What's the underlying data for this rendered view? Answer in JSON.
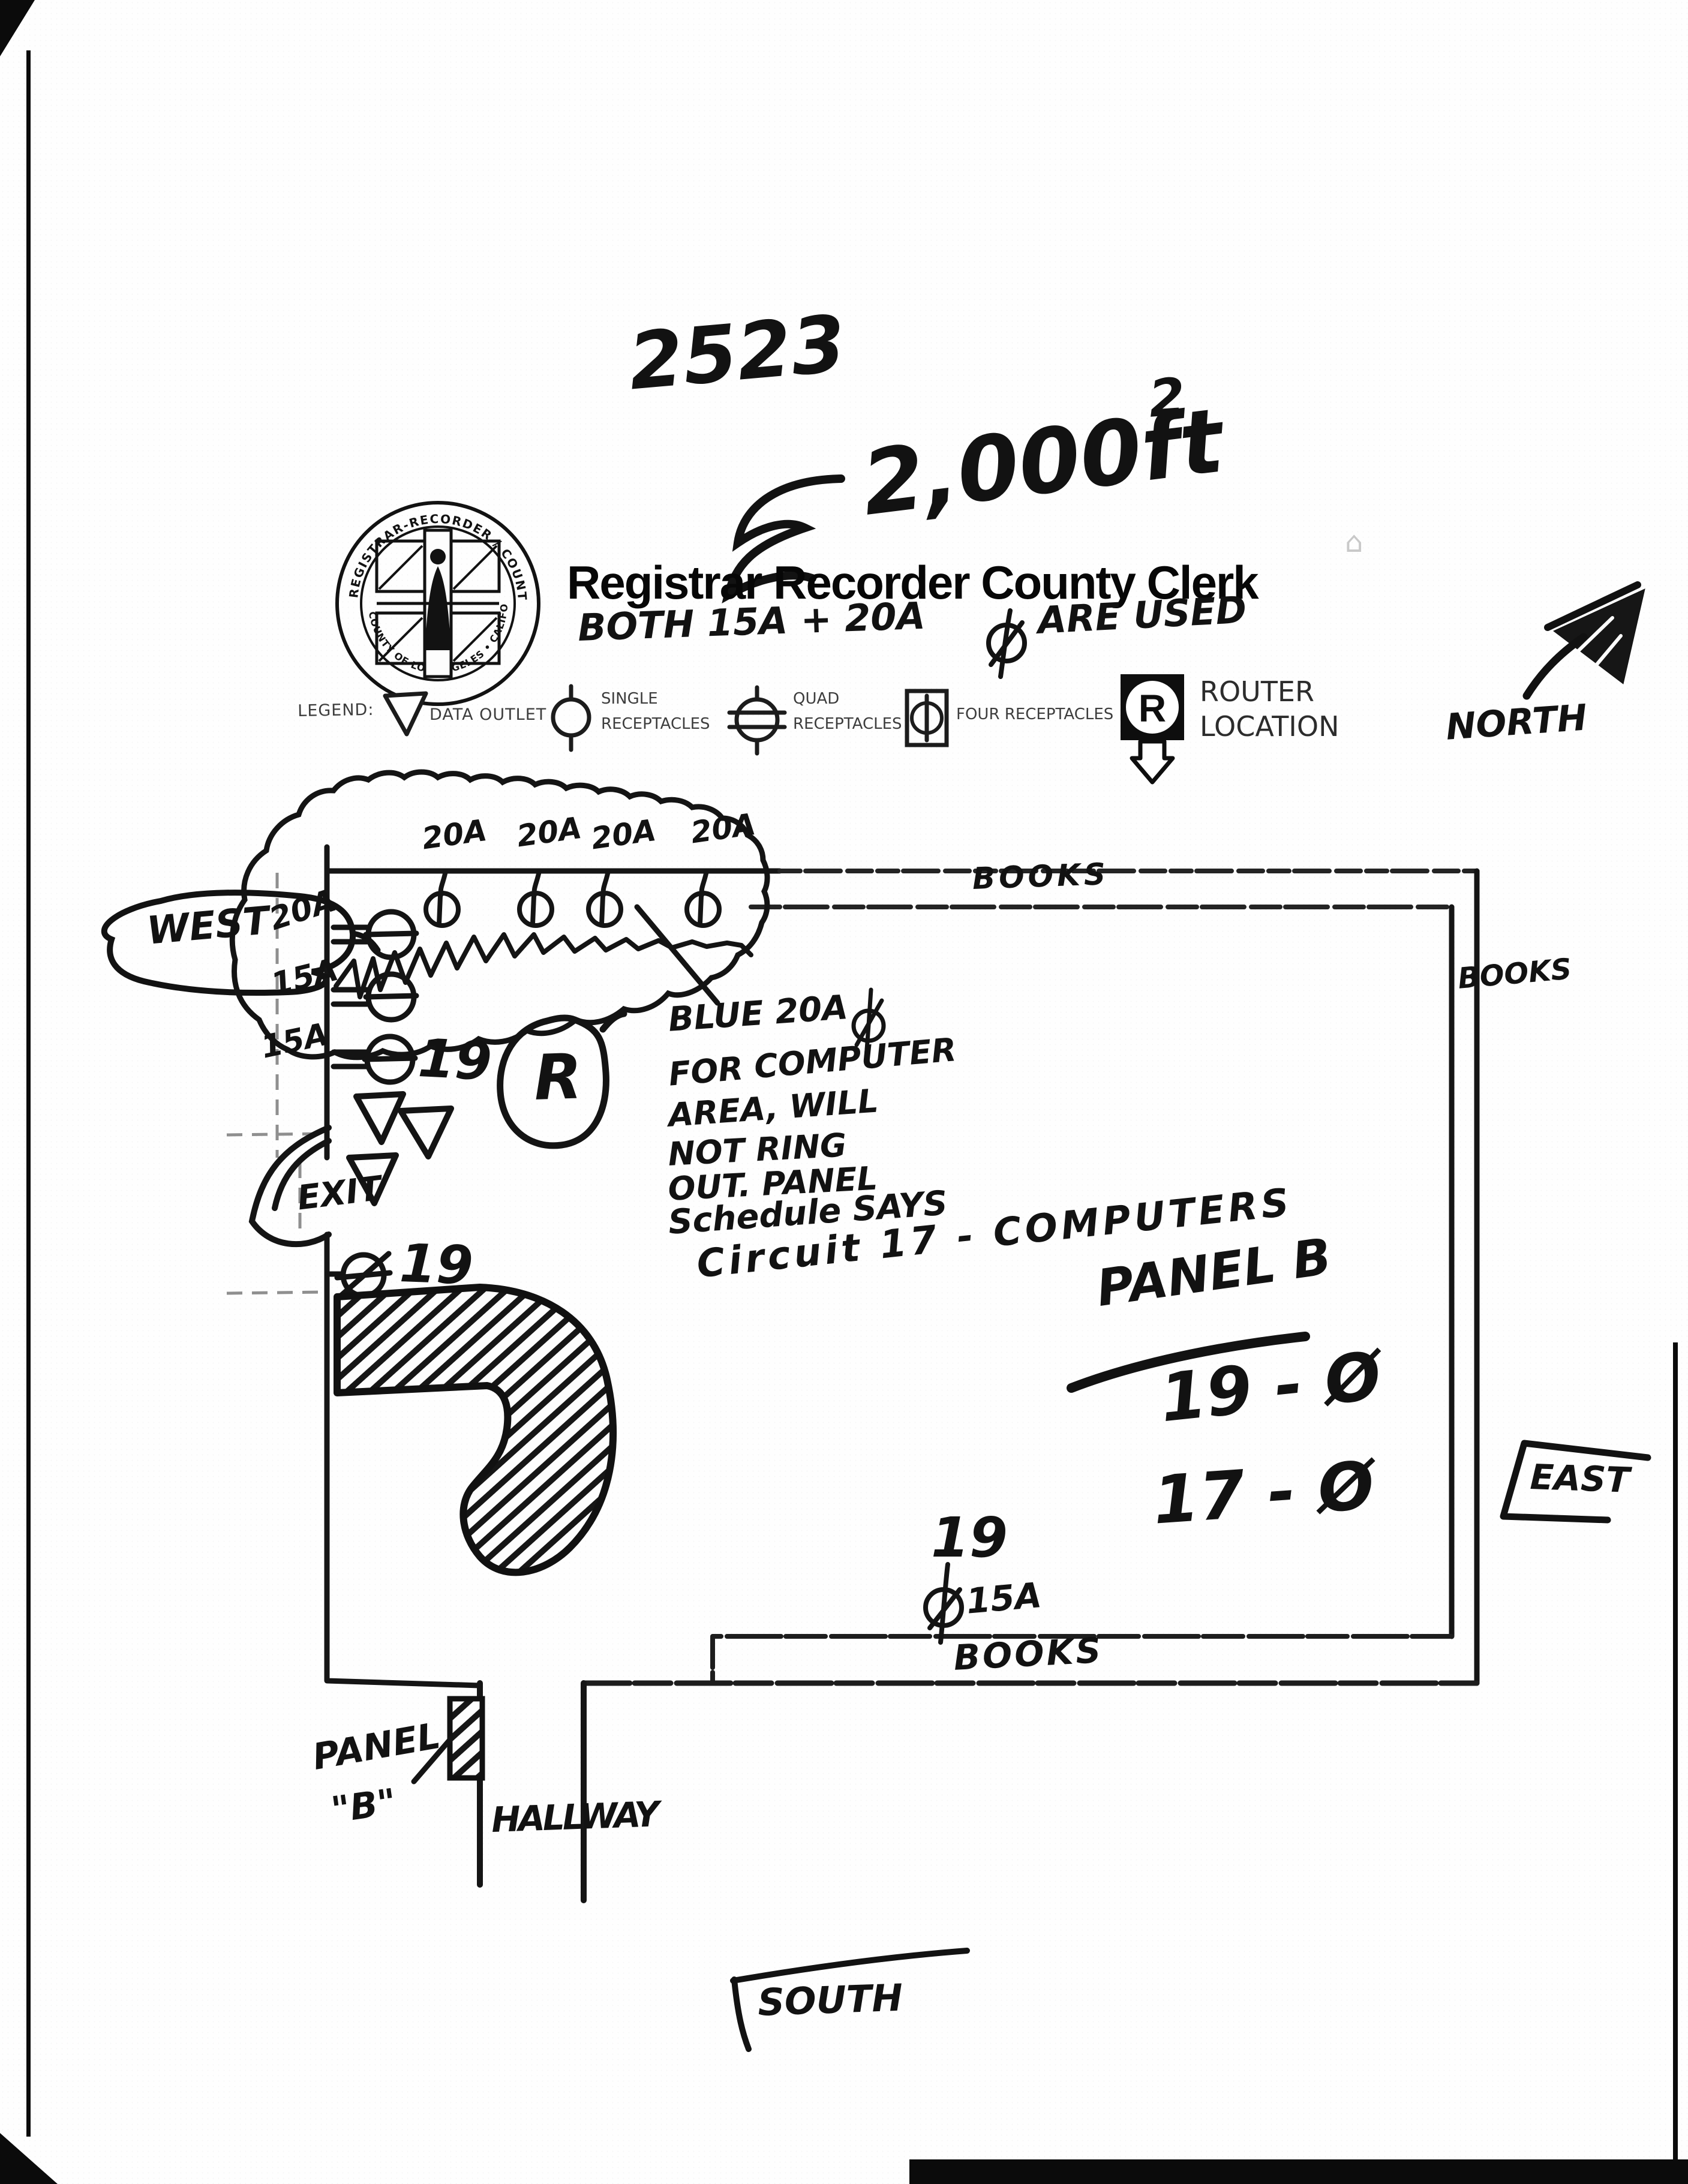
{
  "header": {
    "sheet_number": "2523",
    "approx_symbol": "≈",
    "area_value": "2,000ft",
    "area_exponent": "2",
    "title": "Registrar Recorder County Clerk",
    "faint_glyph": "⌂",
    "amps_note_left": "BOTH 15A + 20A",
    "amps_note_right": "ARE USED",
    "seal_ring_top": "REGISTRAR-RECORDER / COUNTY CLERK",
    "seal_ring_bottom": "COUNTY OF LOS ANGELES • CALIFORNIA"
  },
  "legend": {
    "label": "LEGEND:",
    "data_outlet_label": "DATA OUTLET",
    "single_line1": "SINGLE",
    "single_line2": "RECEPTACLES",
    "quad_line1": "QUAD",
    "quad_line2": "RECEPTACLES",
    "four_label": "FOUR RECEPTACLES",
    "router_letter": "R",
    "router_line1": "ROUTER",
    "router_line2": "LOCATION"
  },
  "compass": {
    "north": "NORTH",
    "west": "WEST",
    "east": "EAST",
    "south": "SOUTH"
  },
  "plan": {
    "top_circuit_labels": [
      "20A",
      "20A",
      "20A",
      "20A"
    ],
    "left_circuit_amps": [
      "20A",
      "15A",
      "15A"
    ],
    "left_circuit_number": "19",
    "router_letter": "R",
    "exit_label": "EXIT",
    "exit_circuit": "19",
    "books_top": "BOOKS",
    "books_right": "BOOKS",
    "books_bottom": "BOOKS",
    "note_lines": [
      "BLUE 20A",
      "FOR COMPUTER",
      "AREA, WILL",
      "NOT RING",
      "OUT. PANEL",
      "Schedule SAYS",
      "Circuit 17 - COMPUTERS"
    ],
    "panel_b_title": "PANEL B",
    "panel_b_rows": [
      "19 - Ø",
      "17 - Ø"
    ],
    "floor_circuit": "19",
    "floor_amp": "15A",
    "panel_label_line1": "PANEL",
    "panel_label_line2": "\"B\"",
    "hallway_label": "HALLWAY"
  }
}
